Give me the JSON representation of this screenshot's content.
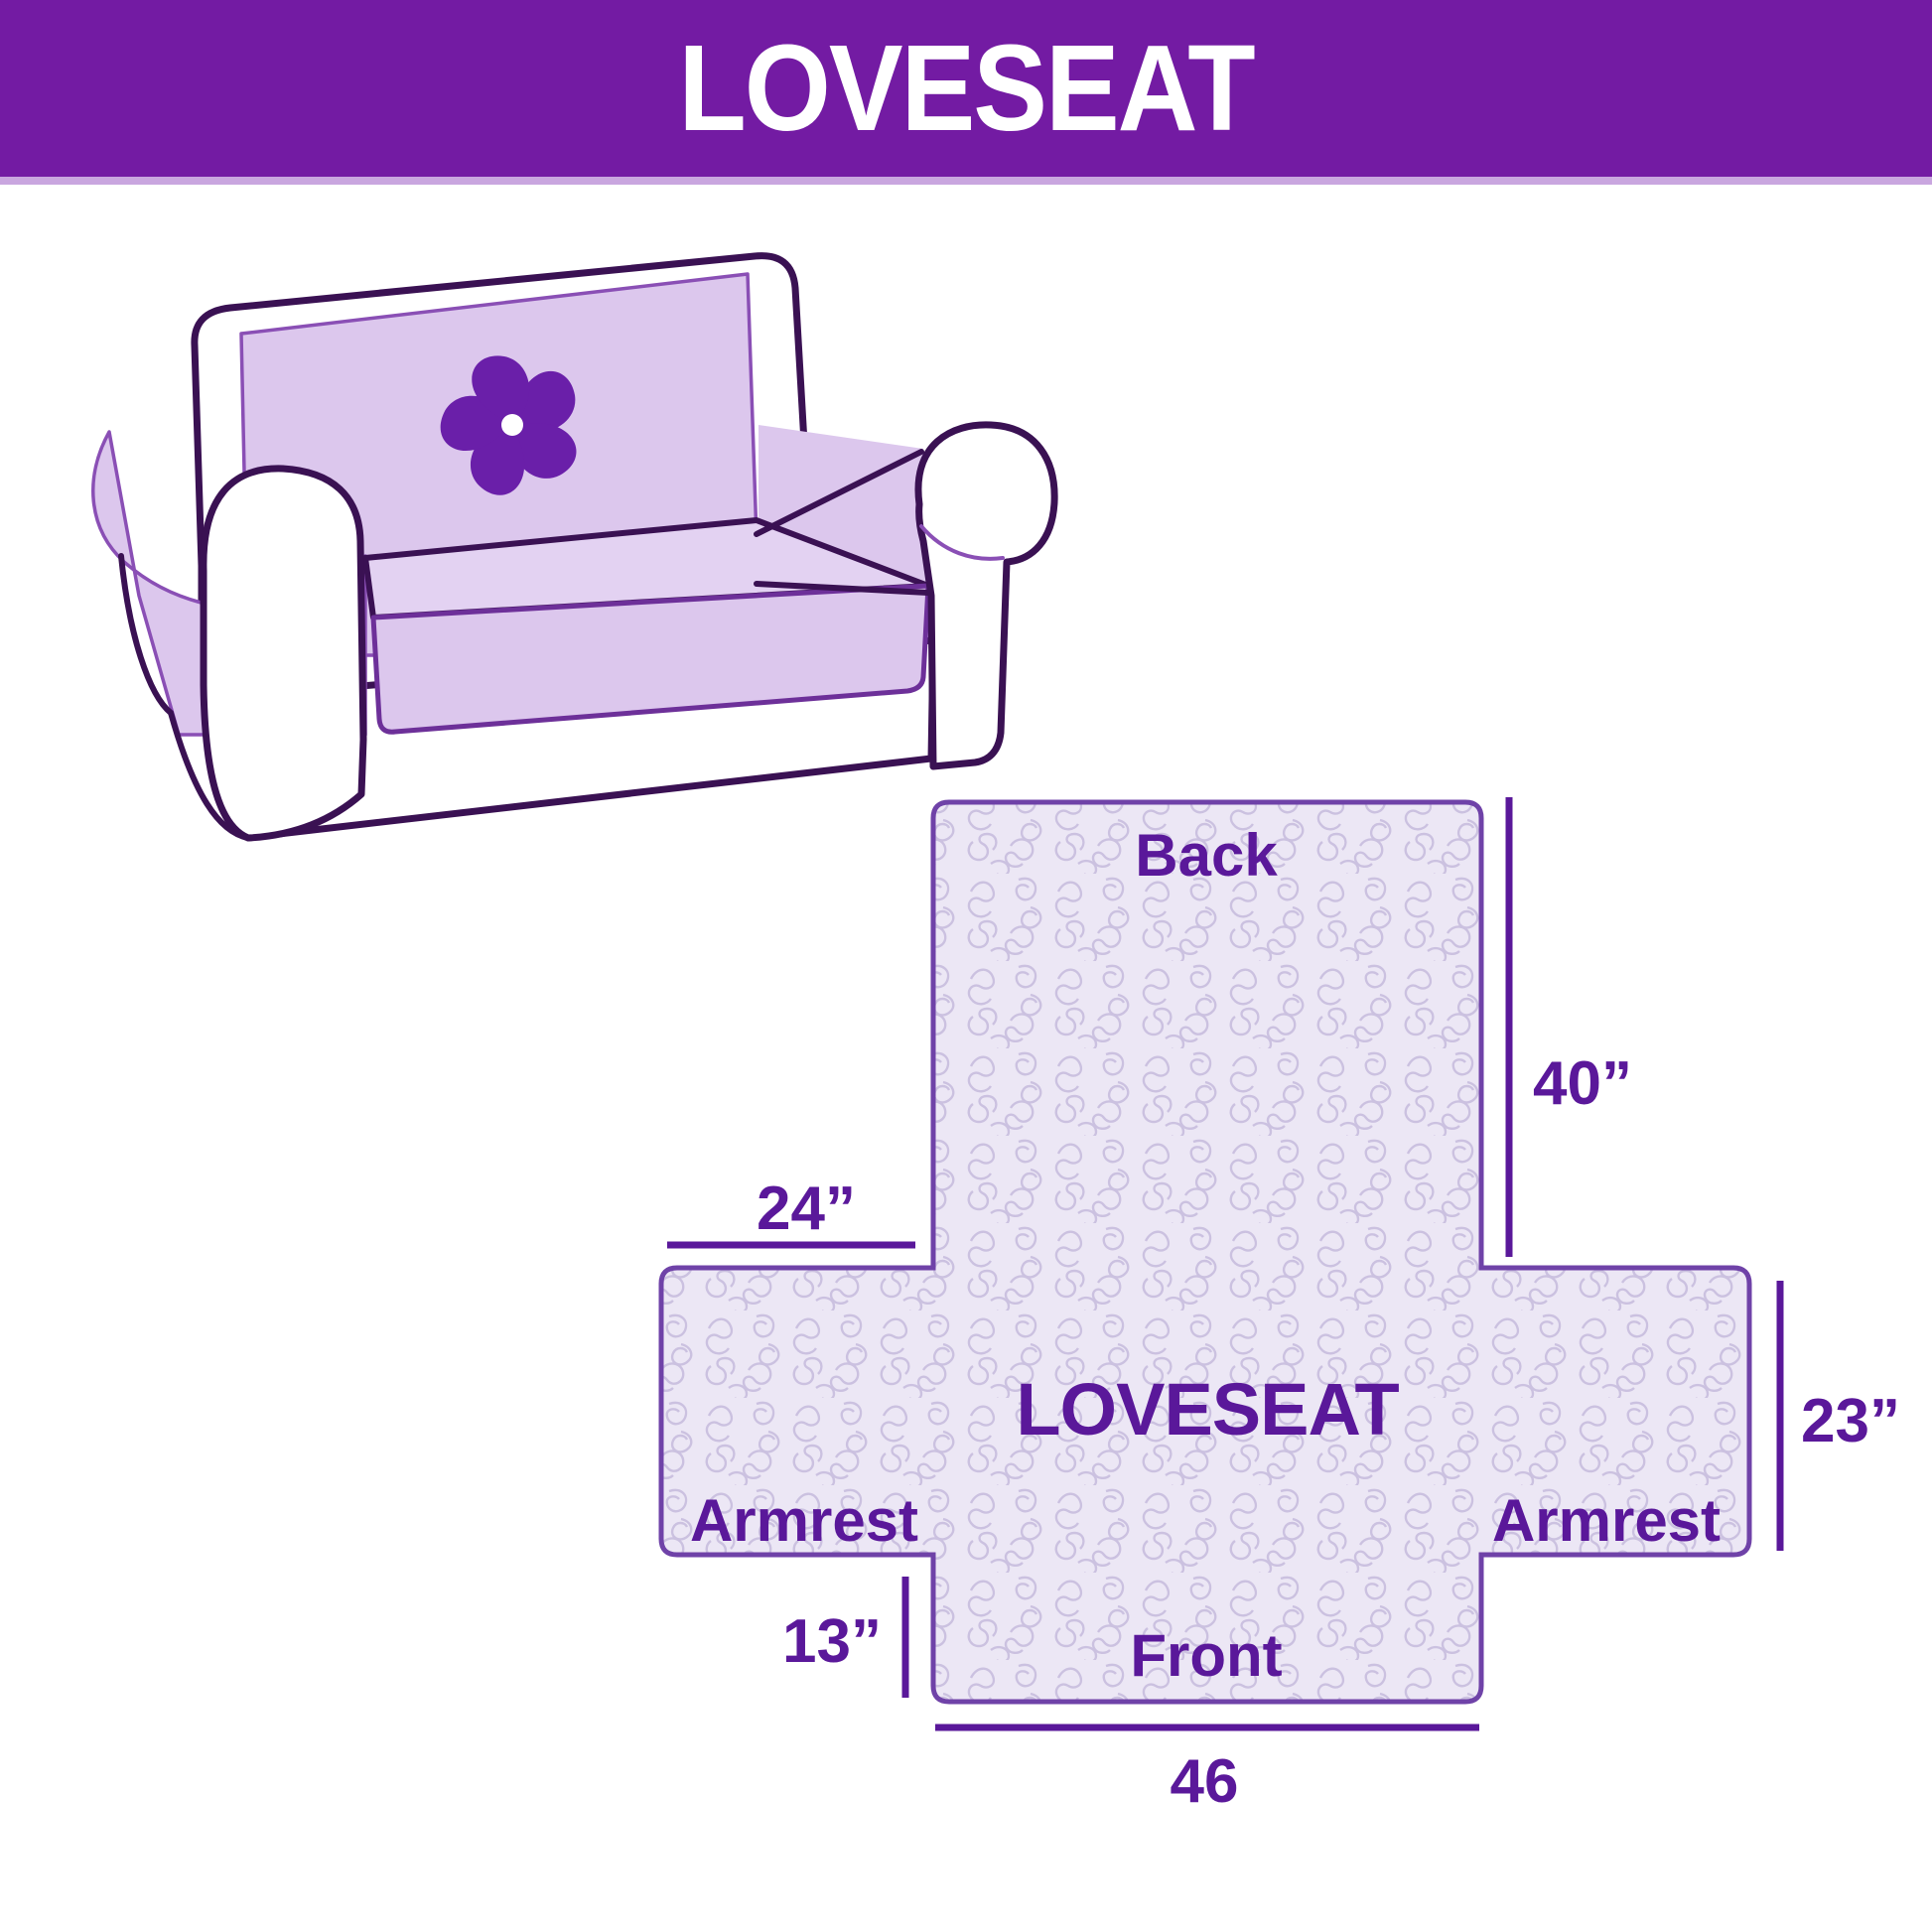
{
  "page": {
    "background": "#ffffff"
  },
  "header": {
    "title": "LOVESEAT",
    "bg_color": "#731ba3",
    "text_color": "#ffffff",
    "accent_stripe_color": "#c9a6df"
  },
  "sofa_illustration": {
    "description": "loveseat sofa drawing with light purple protective cover and pinwheel logo",
    "cover_color": "#dcc7ed",
    "cover_light_color": "#e3d2f2",
    "outline_color": "#3a1153",
    "seam_color": "#8a4fb5",
    "logo_color": "#6a1fa9",
    "logo_icon": "pinwheel-icon"
  },
  "cover_diagram": {
    "center_label": "LOVESEAT",
    "labels": {
      "back": "Back",
      "front": "Front",
      "armrest_left": "Armrest",
      "armrest_right": "Armrest"
    },
    "dimensions": {
      "back_length": "40”",
      "armrest_width": "24”",
      "armrest_depth": "23”",
      "front_drop": "13”",
      "front_width": "46"
    },
    "fabric_color": "#ece7f5",
    "pattern_color": "#cbc1e0",
    "outline_color": "#6f42a8",
    "dimension_color": "#5a189a"
  }
}
